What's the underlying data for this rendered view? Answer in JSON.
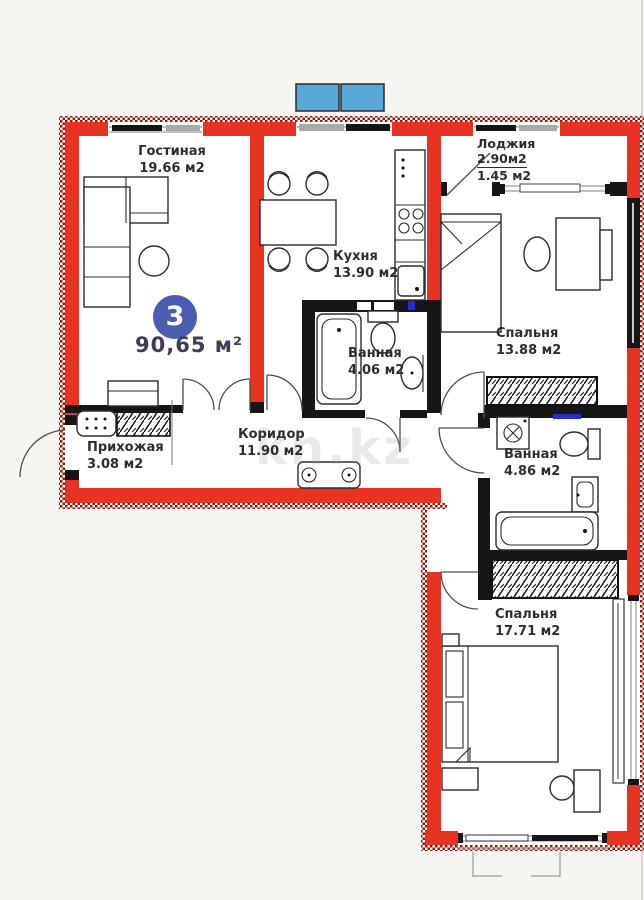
{
  "plan": {
    "badge": "3",
    "total_area": "90,65 м²",
    "watermark": "kn.kz",
    "rooms": {
      "living": {
        "name": "Гостиная",
        "area": "19.66 м2"
      },
      "kitchen": {
        "name": "Кухня",
        "area": "13.90 м2"
      },
      "loggia": {
        "name": "Лоджия",
        "area_full": "2.90м2",
        "area_counted": "1.45 м2"
      },
      "bedroom1": {
        "name": "Спальня",
        "area": "13.88 м2"
      },
      "bath1": {
        "name": "Ванная",
        "area": "4.06 м2"
      },
      "bath2": {
        "name": "Ванная",
        "area": "4.86 м2"
      },
      "corridor": {
        "name": "Коридор",
        "area": "11.90 м2"
      },
      "hallway": {
        "name": "Прихожая",
        "area": "3.08 м2"
      },
      "bedroom2": {
        "name": "Спальня",
        "area": "17.71 м2"
      }
    },
    "colors": {
      "wall_red": "#e73322",
      "wall_black": "#161616",
      "badge_blue": "#4b5db1",
      "ac_blue": "#58a9d8",
      "accent_blue": "#2a2ad4"
    }
  }
}
